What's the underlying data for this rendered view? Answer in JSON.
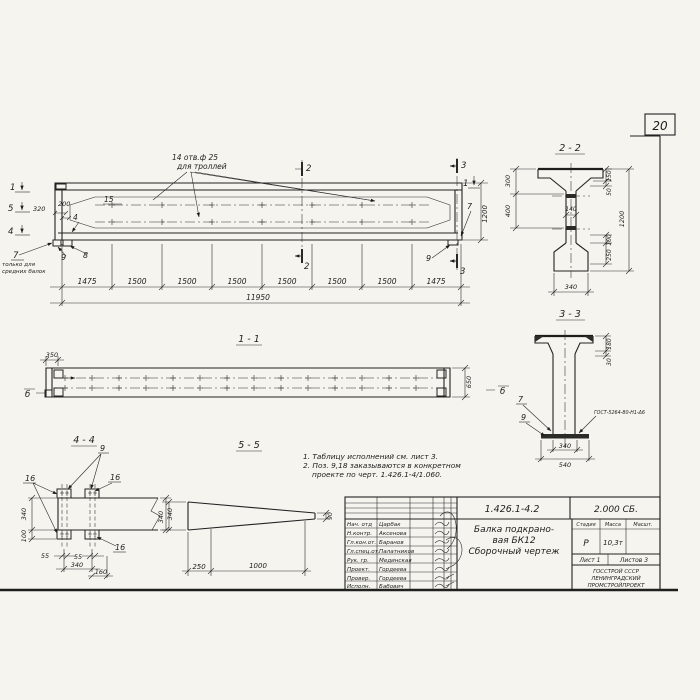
{
  "page": {
    "number": "20"
  },
  "main_view": {
    "callout": {
      "line1": "14 отв.ф 25",
      "line2": "для троллей"
    },
    "marks": {
      "m1_left": "1",
      "m5_left": "5",
      "m4_left": "4",
      "m2_top": "2",
      "m2_bot": "2",
      "m3_top": "3",
      "m3_bot": "3",
      "m1_right": "1"
    },
    "pos": {
      "p15": "15",
      "p4": "4",
      "p7_left": "7",
      "p9_left": "9",
      "p8": "8",
      "p7_right": "7",
      "p9_right": "9"
    },
    "note_left": {
      "line1": "только для",
      "line2": "средних балок"
    },
    "dims": {
      "d320": "320",
      "d200": "200",
      "d1200": "1200",
      "segments": [
        "1475",
        "1500",
        "1500",
        "1500",
        "1500",
        "1500",
        "1500",
        "1475"
      ],
      "total": "11950"
    }
  },
  "section_2_2": {
    "title": "2 - 2",
    "dims": {
      "left_top": "300",
      "left_mid": "400",
      "web": "140",
      "right_1": "150",
      "right_2": "50",
      "right_3": "100",
      "right_4": "250",
      "overall": "1200",
      "bottom": "340"
    }
  },
  "section_3_3": {
    "title": "3 - 3",
    "pos": {
      "p7": "7",
      "p9": "9"
    },
    "weld_note": "ГОСТ-5264-80-Н1-Δ6",
    "dims": {
      "right_1": "180",
      "right_2": "30",
      "bottom_1": "340",
      "bottom_2": "540"
    }
  },
  "view_1_1": {
    "title": "1 - 1",
    "marks": {
      "left": "б",
      "right": "б"
    },
    "dims": {
      "left": "350",
      "right": "650"
    }
  },
  "section_4_4": {
    "title": "4 - 4",
    "pos": {
      "p9": "9",
      "p16_left": "16",
      "p16_right": "16",
      "p16_bottom": "16"
    },
    "dims": {
      "left_1": "340",
      "left_2": "100",
      "bottom_55a": "55",
      "bottom_55b": "55",
      "bottom_340": "340",
      "bottom_160": "160",
      "right": "340"
    }
  },
  "section_5_5": {
    "title": "5 - 5",
    "dims": {
      "left": "340",
      "bottom_1": "250",
      "bottom_2": "1000",
      "tip": "90"
    }
  },
  "notes": {
    "line1": "1. Таблицу исполнений см. лист 3.",
    "line2": "2. Поз. 9,18 заказываются в конкретном",
    "line3": "проекте по черт. 1.426.1-4/1.060."
  },
  "title_block": {
    "doc_number": "1.426.1-4.2",
    "doc_code": "2.000 СБ.",
    "title_line1": "Балка подкрано-",
    "title_line2": "вая БК12",
    "title_line3": "Сборочный чертеж",
    "cols": {
      "stage_h": "Стадия",
      "mass_h": "Масса",
      "scale_h": "Масшт.",
      "stage": "Р",
      "mass": "10,3т",
      "scale": ""
    },
    "sheet": {
      "list": "Лист 1",
      "of": "Листов 3"
    },
    "org": {
      "line1": "ГОССТРОЙ СССР",
      "line2": "ЛЕНИНГРАДСКИЙ",
      "line3": "ПРОМСТРОЙПРОЕКТ"
    },
    "rows": [
      {
        "role": "Нач. отд",
        "name": "Царбак"
      },
      {
        "role": "Н.контр.",
        "name": "Аксенова"
      },
      {
        "role": "Гл.кон.от.",
        "name": "Баранов"
      },
      {
        "role": "Гл.спец.от.",
        "name": "Палатников"
      },
      {
        "role": "Рук. гр.",
        "name": "Мединская"
      },
      {
        "role": "Проект.",
        "name": "Гордеева"
      },
      {
        "role": "Провер.",
        "name": "Гордеева"
      },
      {
        "role": "Исполн.",
        "name": "Бабович"
      }
    ]
  }
}
